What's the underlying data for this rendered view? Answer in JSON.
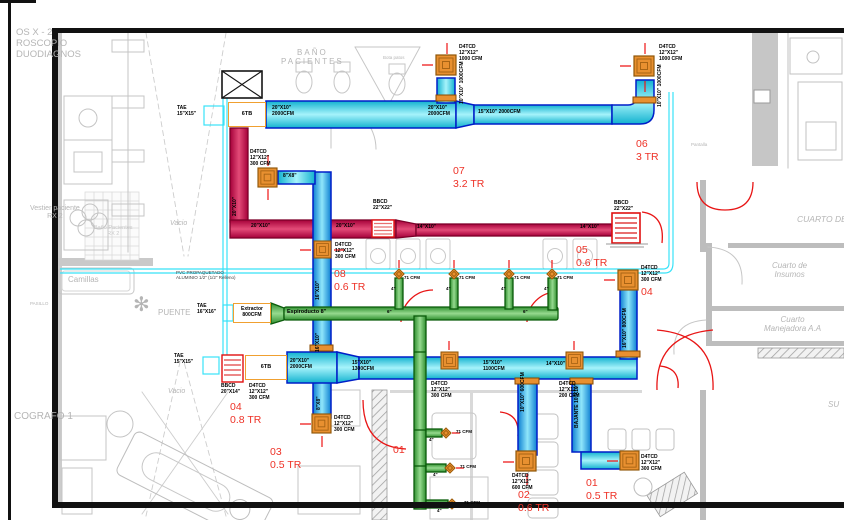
{
  "colors": {
    "duct_blue_border": "#001ec8",
    "duct_cyan": "#12b2cf",
    "duct_red": "#c2074e",
    "duct_green": "#2f8f2f",
    "pipe_cyan": "#38e2f8",
    "diffuser_orange": "#e89030",
    "grille_red": "#e01010",
    "zone_text": "#ee3227",
    "plan_gray": "#c6c6c6"
  },
  "bg": {
    "suite": [
      "OS X  - 2",
      "ROSCOPIO",
      "DUODIAGNOS"
    ],
    "bano": [
      "BAÑO",
      "PACIENTES"
    ],
    "bota": "Bota patos",
    "vestier": [
      "Vestier paciente",
      "RX 2"
    ],
    "bano_rx": [
      "Baño Pacientes",
      "RX 2"
    ],
    "vacio": "Vacio",
    "camillas": "Camillas",
    "pasillo": "PASILLO",
    "puente": "PUENTE",
    "pantalla": "Pantalla",
    "cuarto_de": "CUARTO DE",
    "insumos": [
      "Cuarto  de",
      "Insumos"
    ],
    "manejadora": [
      "Cuarto",
      "Manejadora A.A"
    ],
    "ecografo": "COGRAFO 1",
    "su": "SU"
  },
  "icons": {
    "plant": "✻"
  },
  "zones": [
    {
      "num": "06",
      "tr": "3 TR"
    },
    {
      "num": "07",
      "tr": "3.2 TR"
    },
    {
      "num": "05",
      "tr": "0.6 TR"
    },
    {
      "num": "08",
      "tr": "0.6 TR"
    },
    {
      "num": "04",
      "tr": "0.8 TR"
    },
    {
      "num": "04",
      "tr": ""
    },
    {
      "num": "03",
      "tr": "0.5 TR"
    },
    {
      "num": "01",
      "tr": ""
    },
    {
      "num": "02",
      "tr": "0.6 TR"
    },
    {
      "num": "01",
      "tr": "0.5 TR"
    }
  ],
  "dl": {
    "tae_top": [
      "TAE",
      "15\"X15\""
    ],
    "tae_mid": [
      "TAE",
      "16\"X16\""
    ],
    "tae_bot": [
      "TAE",
      "15\"X15\""
    ],
    "unit_top": "6TB",
    "unit_bot": "6TB",
    "extractor": [
      "Extractor",
      "800CFM"
    ],
    "espiro": "Espiroducto 8\"",
    "seg_a": [
      "20\"X10\"",
      "2000CFM"
    ],
    "seg_b": [
      "20\"X10\"",
      "2000CFM"
    ],
    "seg_c": "15\"X10\"  2000CFM",
    "dif_a": [
      "D4TCD",
      "12\"X12\"",
      "1000 CFM"
    ],
    "dif_b": [
      "D4TCD",
      "12\"X12\"",
      "1000 CFM"
    ],
    "riser_a": "10\"X10\" 1000CFM",
    "riser_b": "10\"X10\" 1000CFM",
    "red_riser": "20\"X10\"",
    "red_seg1": "20\"X10\"",
    "red_seg2": "20\"X10\"",
    "red_seg3": "14\"X10\"",
    "red_seg4": "14\"X10\"",
    "grille_mid": [
      "BBCD",
      "22\"X22\""
    ],
    "grille_end": [
      "BBCD",
      "22\"X22\""
    ],
    "grille_left": [
      "BBCD",
      "20\"X14\""
    ],
    "dif_c": [
      "D4TCD",
      "12\"X12\"",
      "300  CFM"
    ],
    "dif_d": [
      "D4TCD",
      "12\"X12\"",
      "300  CFM"
    ],
    "seg_8x8": "8\"X8\"",
    "riser_c": "16\"X10\"",
    "pvc": [
      "PVC PROPAQUETADO",
      "ALUMINIO 1/2\" (1/2\" Relleno)"
    ],
    "bot_seg1": [
      "20\"X10\"",
      "2000CFM"
    ],
    "bot_seg2": [
      "15\"X10\"",
      "1300CFM"
    ],
    "bot_seg3": [
      "15\"X10\"",
      "1100CFM"
    ],
    "bot_seg4": "14\"X10\"",
    "dif_e": [
      "D4TCD",
      "12\"X12\"",
      "300  CFM"
    ],
    "dif_f": [
      "D4TCD",
      "12\"X12\"",
      "300  CFM"
    ],
    "dif_g": [
      "D4TCD",
      "12\"X12\"",
      "200  CFM"
    ],
    "dif_h": [
      "D4TCD",
      "12\"X12\"",
      "300  CFM"
    ],
    "dif_i": [
      "D4TCD",
      "12\"X12\"",
      "600  CFM"
    ],
    "dif_j": [
      "D4TCD",
      "12\"X12\"",
      "300  CFM"
    ],
    "dif_k": [
      "D4TCD",
      "12\"X12\"",
      "300  CFM"
    ],
    "riser_d": "16\"X10\" 800CFM",
    "riser_e": "10\"X10\" 600CFM",
    "riser_f": "BAJANTE 10\"X10\"",
    "riser_g": "8\"X8\"",
    "cfm71": "71  CFM",
    "in4": "4\"",
    "in6": "6\""
  }
}
